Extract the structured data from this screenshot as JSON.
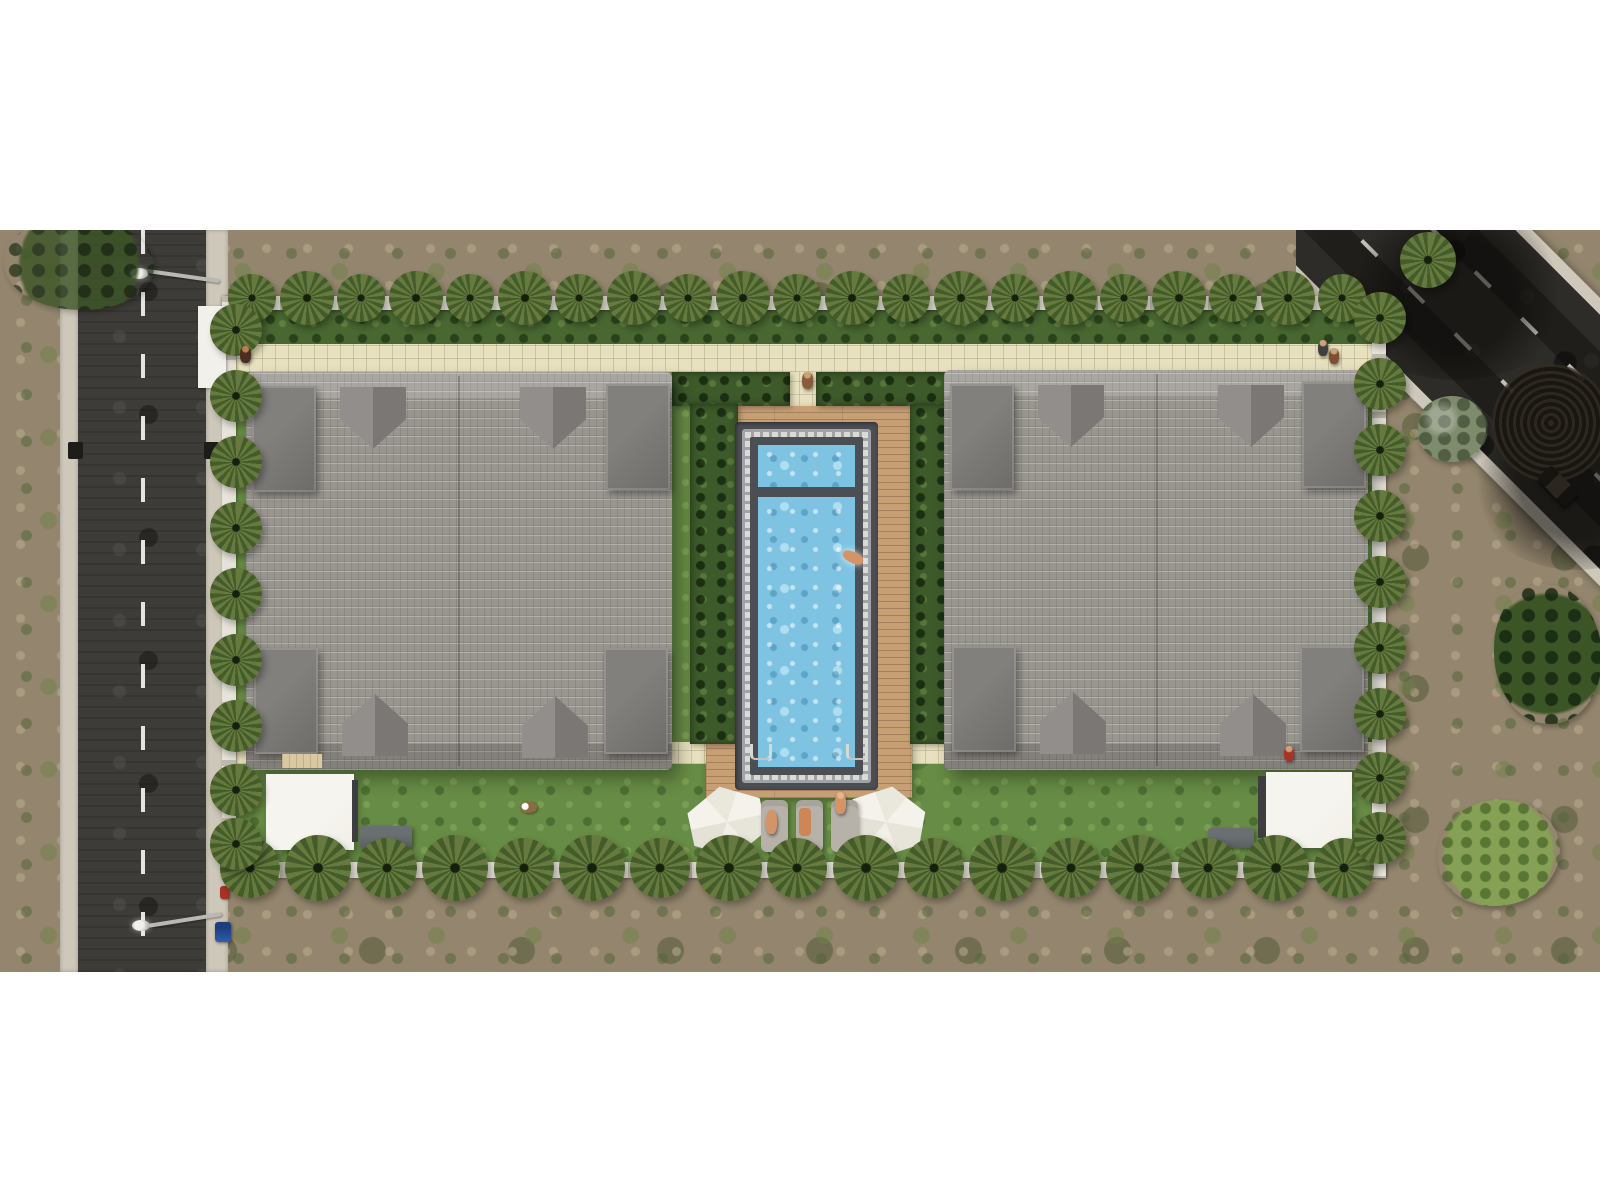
{
  "meta": {
    "description": "Top-down aerial 3D architectural rendering of a walled residential compound: two gray-tile-roof villa buildings flanking a central rectangular swimming pool with wood deck, hedges, lawns and perimeter palm trees; a vertical street on the west side and a diagonal street at the north-east corner, surrounded by scrubland",
    "view": "top-down-aerial",
    "visible_text": "none"
  },
  "colors": {
    "page_bg": "#ffffff",
    "scrub": "#94866e",
    "road": "#3e3c38",
    "road_dark": "#2e2c28",
    "road_line": "#e4e4e0",
    "sidewalk": "#cec8ba",
    "wall": "#e6e3da",
    "wall_post": "#bdb9ac",
    "gate": "#f2f0ea",
    "lawn": "#678c45",
    "hedge": "#3d5a2a",
    "shrub": "#486731",
    "path": "#e8e1bf",
    "palm_light": "#66793f",
    "palm_dark": "#435c29",
    "roof": "#99958f",
    "tower": "#767472",
    "dormer_light": "#918e8b",
    "dormer_dark": "#7a7774",
    "deck": "#c79f75",
    "pool_frame": "#4b4f54",
    "pool_band": "#dbdad5",
    "pool_band_mark": "#9fa2a6",
    "water": "#7fc3e2",
    "umbrella": "#f3f0e9",
    "lounger": "#b7b2a9",
    "canopy": "#f1efe8",
    "canopy_edge": "#3c3e40",
    "equipment": "#5a5f62",
    "skin": "#d59468",
    "towel": "#cd8757",
    "red": "#a83226",
    "blue": "#2f5db0",
    "tree_olive": "#7e8b6c"
  },
  "scene": {
    "compound": {
      "perimeter_wall": true,
      "entrance_gate": "west-wall",
      "walkways": "beige-paver",
      "palm_rows": 4
    },
    "buildings": [
      {
        "label": "villa-west",
        "roof": "gray-tile-hip",
        "corner_towers": 4,
        "dormers": 4
      },
      {
        "label": "villa-east",
        "roof": "gray-tile-hip",
        "corner_towers": 4,
        "dormers": 4
      }
    ],
    "pool": {
      "label": "swimming-pool",
      "sections": 2,
      "divider_bridge": 1,
      "ladders": 2,
      "deck": "wood-plank",
      "surround": "hedges"
    },
    "amenities": {
      "hexagonal_umbrellas": 2,
      "sun_loungers": 3,
      "white_canopies": 2,
      "equipment_units": 2,
      "garden_step_deck": 1
    },
    "streets": [
      {
        "label": "street-west",
        "orientation": "vertical",
        "marking": "dashed-centerline",
        "street_lamps": 2,
        "storm_drains": 2
      },
      {
        "label": "street-northeast",
        "orientation": "diagonal",
        "marking": "dashed-lanes",
        "manhole_stain": 1,
        "vehicle": 1
      }
    ],
    "figures": {
      "people": 9,
      "swimmer": 1,
      "dog": 1
    },
    "street_furniture": {
      "waste_bin": 1,
      "hydrant": 1
    },
    "vegetation": {
      "palm_trees": "perimeter rows",
      "olive_tree": 1,
      "scrub_trees": 3,
      "hedges": "pool courtyard",
      "lawn": "compound interior",
      "scrubland": "outside compound"
    }
  }
}
